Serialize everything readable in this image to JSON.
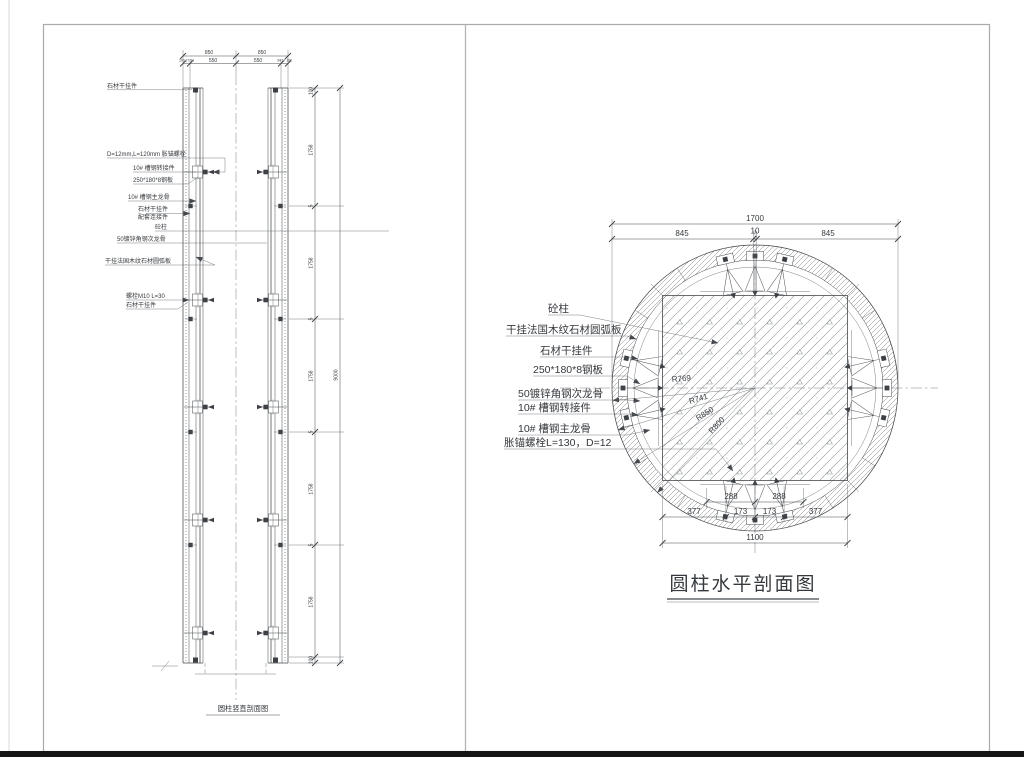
{
  "page": {
    "bottom_bar_color": "#151515",
    "frame_color": "#a8abae",
    "ink_color": "#45494d"
  },
  "left_view": {
    "title": "圆柱竖直剖面图",
    "dims": {
      "top_row1": [
        "850",
        "850"
      ],
      "top_row2_left": "100 17 34",
      "top_row2_center": [
        "550",
        "550"
      ],
      "top_row2_right": "34 17 100",
      "side_segments": [
        "100",
        "1758",
        "5",
        "1758",
        "5",
        "1758",
        "5",
        "1758",
        "5",
        "1758",
        "100"
      ],
      "side_total": "9000"
    },
    "labels": [
      "石材干挂件",
      "D=12mm,L=120mm 胀锚螺栓",
      "10# 槽钢转接件",
      "250*180*8钢板",
      "10# 槽钢主龙骨",
      "石材干挂件",
      "配套连接件",
      "砼柱",
      "50镀锌角钢次龙骨",
      "干挂法国木纹石材圆弧板",
      "螺栓M10 L=30",
      "石材干挂件"
    ]
  },
  "right_view": {
    "title": "圆柱水平剖面图",
    "dims": {
      "top_total": "1700",
      "top_row2": [
        "845",
        "10",
        "845"
      ],
      "bottom_row1": [
        "288",
        "288"
      ],
      "bottom_row2": [
        "377",
        "173",
        "173",
        "377"
      ],
      "bottom_total": "1100"
    },
    "radii": [
      "R769",
      "R741",
      "R850",
      "R800"
    ],
    "labels": [
      "砼柱",
      "干挂法国木纹石材圆弧板",
      "石材干挂件",
      "250*180*8钢板",
      "50镀锌角钢次龙骨",
      "10# 槽钢转接件",
      "10# 槽钢主龙骨",
      "胀锚螺栓L=130，D=12"
    ]
  }
}
